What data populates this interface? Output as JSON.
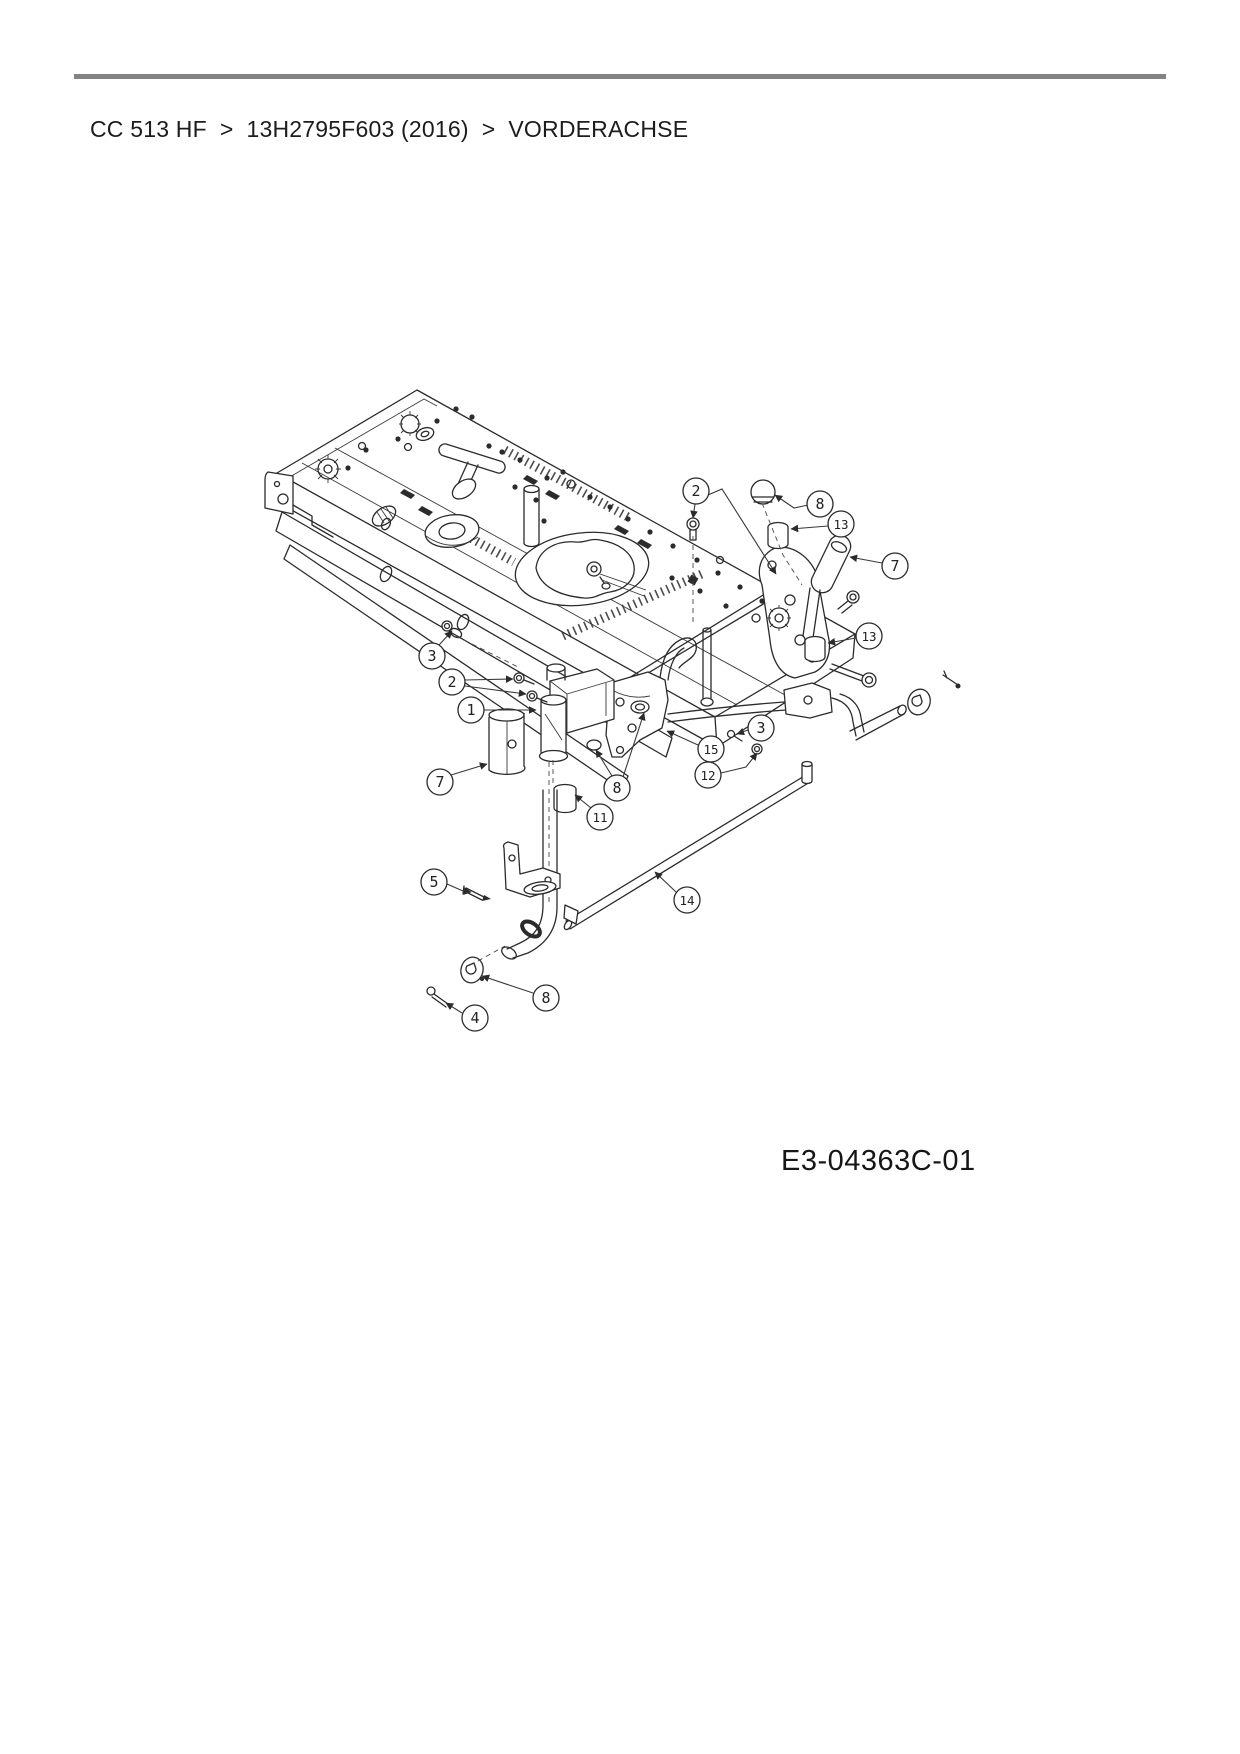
{
  "page": {
    "background_color": "#ffffff"
  },
  "header": {
    "rule_color": "#838383",
    "breadcrumb": {
      "separator": ">",
      "items": [
        "CC 513 HF",
        "13H2795F603 (2016)",
        "VORDERACHSE"
      ]
    }
  },
  "diagram": {
    "description": "Exploded parts drawing of the front axle (Vorderachse)",
    "drawing_number": "E3-04363C-01",
    "line_color": "#2b2b2b",
    "callouts": [
      {
        "n": "2",
        "cx": 696,
        "cy": 491,
        "leaders": [
          [
            [
              708,
              495
            ],
            [
              722,
              489
            ],
            [
              776,
              574
            ]
          ],
          [
            [
              695,
              504
            ],
            [
              693,
              518
            ]
          ]
        ]
      },
      {
        "n": "8",
        "cx": 820,
        "cy": 504,
        "leaders": [
          [
            [
              808,
              505
            ],
            [
              794,
              508
            ],
            [
              775,
              495
            ]
          ]
        ]
      },
      {
        "n": "13",
        "cx": 841,
        "cy": 524,
        "leaders": [
          [
            [
              828,
              526
            ],
            [
              791,
              529
            ]
          ]
        ]
      },
      {
        "n": "7",
        "cx": 895,
        "cy": 566,
        "leaders": [
          [
            [
              882,
              563
            ],
            [
              850,
              557
            ]
          ]
        ]
      },
      {
        "n": "13",
        "cx": 869,
        "cy": 636,
        "leaders": [
          [
            [
              856,
              638
            ],
            [
              828,
              643
            ]
          ]
        ]
      },
      {
        "n": "3",
        "cx": 432,
        "cy": 656,
        "leaders": [
          [
            [
              439,
              645
            ],
            [
              452,
              631
            ]
          ]
        ]
      },
      {
        "n": "2",
        "cx": 452,
        "cy": 682,
        "leaders": [
          [
            [
              465,
              680
            ],
            [
              513,
              679
            ]
          ],
          [
            [
              465,
              686
            ],
            [
              526,
              694
            ]
          ]
        ]
      },
      {
        "n": "1",
        "cx": 471,
        "cy": 710,
        "leaders": [
          [
            [
              484,
              710
            ],
            [
              536,
              710
            ]
          ]
        ]
      },
      {
        "n": "7",
        "cx": 440,
        "cy": 782,
        "leaders": [
          [
            [
              451,
              775
            ],
            [
              487,
              764
            ]
          ]
        ]
      },
      {
        "n": "8",
        "cx": 617,
        "cy": 788,
        "leaders": [
          [
            [
              612,
              776
            ],
            [
              596,
              750
            ]
          ],
          [
            [
              623,
              777
            ],
            [
              644,
              713
            ]
          ]
        ]
      },
      {
        "n": "11",
        "cx": 600,
        "cy": 817,
        "leaders": [
          [
            [
              591,
              808
            ],
            [
              575,
              795
            ]
          ]
        ]
      },
      {
        "n": "15",
        "cx": 711,
        "cy": 749,
        "leaders": [
          [
            [
              698,
              745
            ],
            [
              667,
              731
            ]
          ]
        ]
      },
      {
        "n": "12",
        "cx": 708,
        "cy": 775,
        "leaders": [
          [
            [
              721,
              773
            ],
            [
              746,
              767
            ],
            [
              757,
              753
            ]
          ]
        ]
      },
      {
        "n": "3",
        "cx": 761,
        "cy": 728,
        "leaders": [
          [
            [
              748,
              730
            ],
            [
              737,
              734
            ]
          ]
        ]
      },
      {
        "n": "14",
        "cx": 687,
        "cy": 900,
        "leaders": [
          [
            [
              676,
              892
            ],
            [
              655,
              872
            ]
          ]
        ]
      },
      {
        "n": "5",
        "cx": 434,
        "cy": 882,
        "leaders": [
          [
            [
              447,
              884
            ],
            [
              463,
              891
            ],
            [
              471,
              892
            ]
          ]
        ]
      },
      {
        "n": "8",
        "cx": 546,
        "cy": 998,
        "leaders": [
          [
            [
              533,
              993
            ],
            [
              482,
              976
            ]
          ]
        ]
      },
      {
        "n": "4",
        "cx": 475,
        "cy": 1018,
        "leaders": [
          [
            [
              462,
              1013
            ],
            [
              446,
              1003
            ]
          ]
        ]
      }
    ]
  }
}
